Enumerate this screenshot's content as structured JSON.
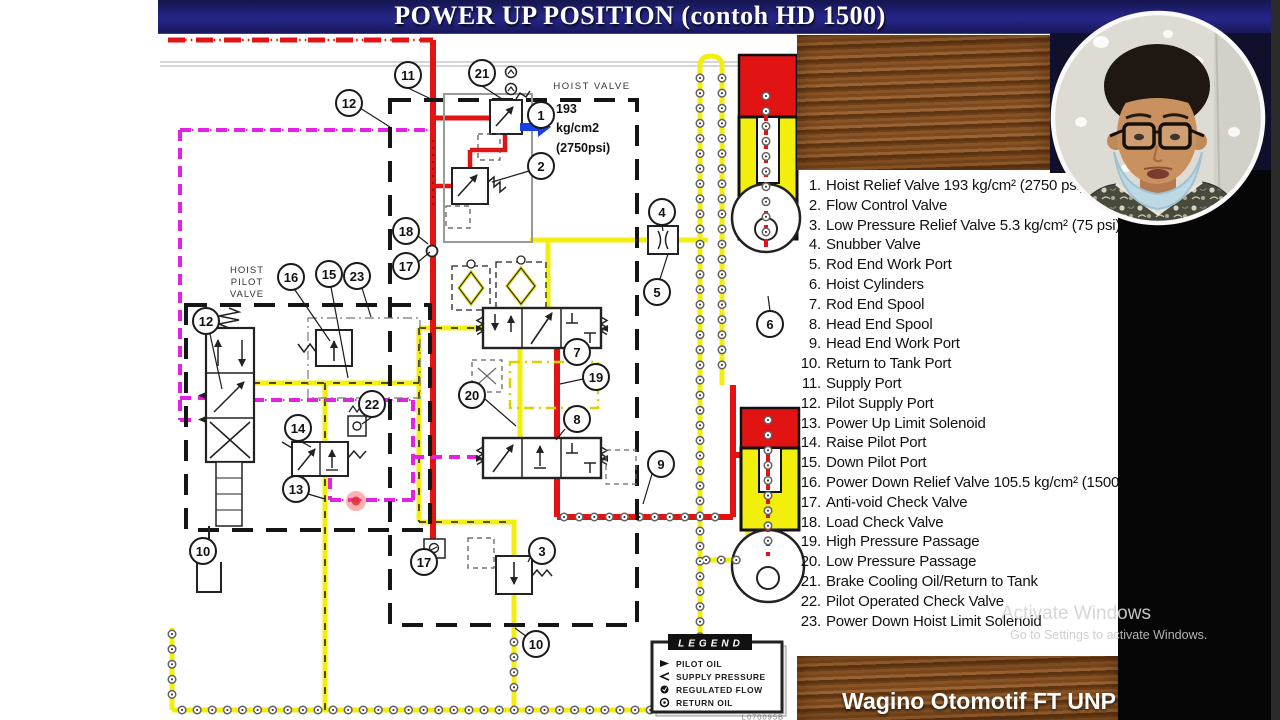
{
  "title_bar": {
    "title": "POWER UP POSITION (contoh HD 1500)"
  },
  "diagram": {
    "hoist_valve_label": "HOIST VALVE",
    "pilot_valve_label_lines": [
      "HOIST",
      "PILOT",
      "VALVE"
    ],
    "pressure_note": [
      "193",
      "kg/cm2",
      "(2750psi)"
    ],
    "callouts": {
      "n1": "1",
      "n2": "2",
      "n3": "3",
      "n4": "4",
      "n5": "5",
      "n6": "6",
      "n7": "7",
      "n8": "8",
      "n9": "9",
      "n10": "10",
      "n11": "11",
      "n12": "12",
      "n13": "13",
      "n14": "14",
      "n15": "15",
      "n16": "16",
      "n17": "17",
      "n18": "18",
      "n19": "19",
      "n20": "20",
      "n21": "21",
      "n22": "22",
      "n23": "23"
    },
    "legend": {
      "title": "LEGEND",
      "items": [
        "PILOT OIL",
        "SUPPLY PRESSURE",
        "REGULATED FLOW",
        "RETURN OIL"
      ],
      "code": "L070095B"
    },
    "colors": {
      "pilot_oil": "#e520e5",
      "supply_pressure": "#e21313",
      "return_low_pressure": "#f3ef0c"
    }
  },
  "parts_list": {
    "items": [
      {
        "num": "1.",
        "label": "Hoist Relief Valve 193 kg/cm² (2750 psi)"
      },
      {
        "num": "2.",
        "label": "Flow Control Valve"
      },
      {
        "num": "3.",
        "label": "Low Pressure Relief Valve 5.3 kg/cm² (75 psi)"
      },
      {
        "num": "4.",
        "label": "Snubber Valve"
      },
      {
        "num": "5.",
        "label": "Rod End Work Port"
      },
      {
        "num": "6.",
        "label": "Hoist Cylinders"
      },
      {
        "num": "7.",
        "label": "Rod End Spool"
      },
      {
        "num": "8.",
        "label": "Head End Spool"
      },
      {
        "num": "9.",
        "label": "Head End Work Port"
      },
      {
        "num": "10.",
        "label": "Return to Tank Port"
      },
      {
        "num": "11.",
        "label": "Supply Port"
      },
      {
        "num": "12.",
        "label": "Pilot Supply Port"
      },
      {
        "num": "13.",
        "label": "Power Up Limit Solenoid"
      },
      {
        "num": "14.",
        "label": "Raise Pilot Port"
      },
      {
        "num": "15.",
        "label": "Down Pilot Port"
      },
      {
        "num": "16.",
        "label": "Power Down Relief Valve 105.5 kg/cm² (1500 psi)"
      },
      {
        "num": "17.",
        "label": "Anti-void Check Valve"
      },
      {
        "num": "18.",
        "label": "Load Check Valve"
      },
      {
        "num": "19.",
        "label": "High Pressure Passage"
      },
      {
        "num": "20.",
        "label": "Low Pressure Passage"
      },
      {
        "num": "21.",
        "label": "Brake Cooling Oil/Return to Tank"
      },
      {
        "num": "22.",
        "label": "Pilot Operated Check Valve"
      },
      {
        "num": "23.",
        "label": "Power Down Hoist Limit Solenoid"
      }
    ]
  },
  "watermark": {
    "line1": "Activate Windows",
    "line2": "Go to Settings to activate Windows."
  },
  "footer": {
    "brand": "Wagino Otomotif FT UNP"
  }
}
